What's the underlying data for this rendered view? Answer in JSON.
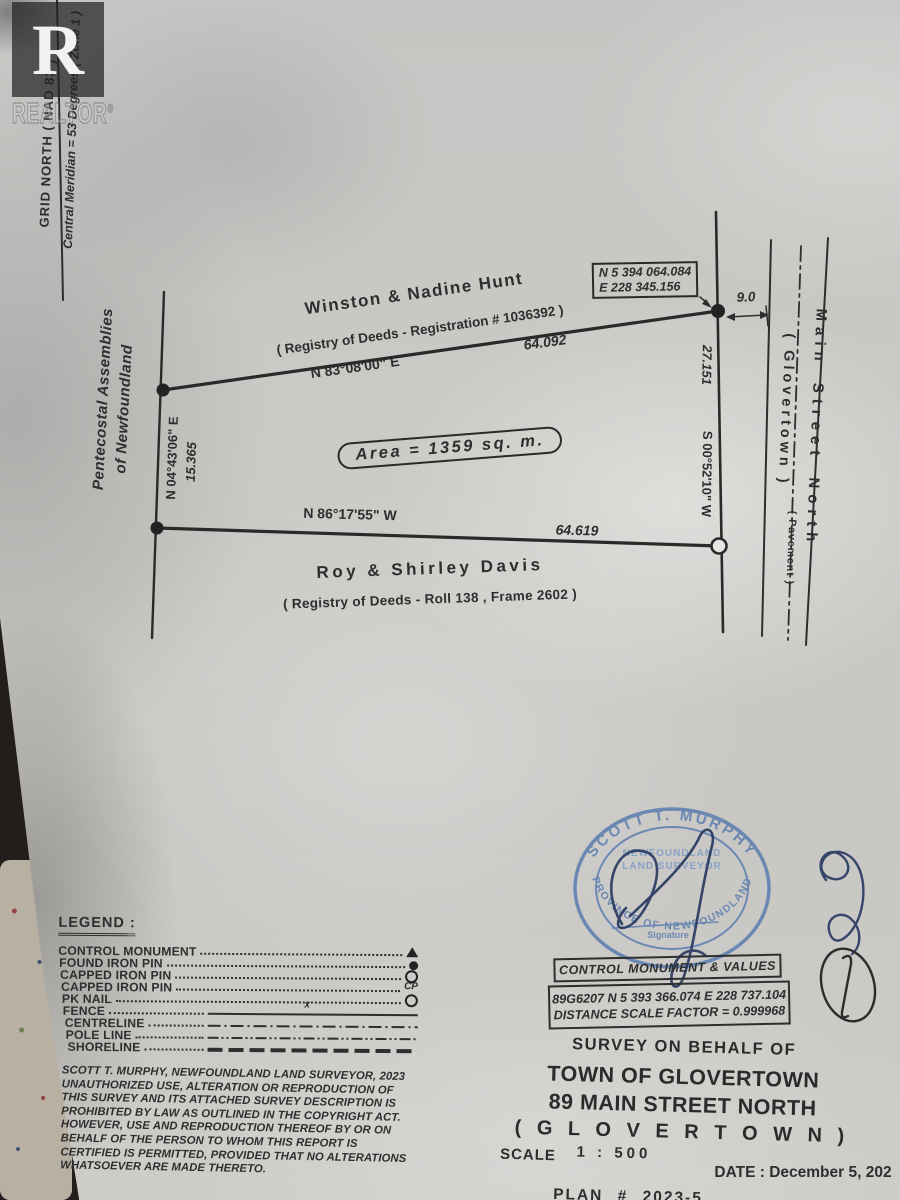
{
  "watermark": {
    "logo_letter": "R",
    "brand": "REALTOR",
    "registered": "®"
  },
  "north": {
    "grid_north": "GRID  NORTH  ( NAD 83 )",
    "central_meridian": "Central Meridian  =  53 Degrees  ( Zone 1 )"
  },
  "parcel": {
    "area_label": "Area  =  1359 sq. m.",
    "north_neighbor": {
      "name": "Winston & Nadine Hunt",
      "registry": "( Registry of Deeds - Registration  #  1036392 )"
    },
    "south_neighbor": {
      "name": "Roy & Shirley Davis",
      "registry": "( Registry of Deeds -  Roll 138 ,  Frame 2602 )"
    },
    "west_neighbor": {
      "line1": "Pentecostal Assemblies",
      "line2": "of Newfoundland"
    },
    "boundaries": {
      "north": {
        "bearing": "N  83°08'00\"  E",
        "distance": "64.092"
      },
      "south": {
        "bearing": "N  86°17'55\"  W",
        "distance": "64.619"
      },
      "west": {
        "bearing": "N 04°43'06\" E",
        "distance": "15.365"
      },
      "east": {
        "bearing": "S 00°52'10\" W",
        "distance": "27.151"
      }
    },
    "corner_coordinates": {
      "northing": "N 5 394 064.084",
      "easting": "E   228 345.156"
    },
    "street_offset": "9.0"
  },
  "street": {
    "name": "Main Street North",
    "paren": "( Glovertown )",
    "surface": "( Pavement )"
  },
  "legend": {
    "title": "LEGEND :",
    "items": [
      {
        "label": "CONTROL MONUMENT",
        "symbol": "control-monument-triangle"
      },
      {
        "label": "FOUND IRON PIN",
        "symbol": "found-iron-pin-filled-circle"
      },
      {
        "label": "CAPPED IRON PIN",
        "symbol": "capped-iron-pin-open-circle"
      },
      {
        "label": "CAPPED IRON PIN",
        "symbol": "capped-iron-pin-cp"
      },
      {
        "label": "PK NAIL",
        "symbol": "pk-nail-circle"
      },
      {
        "label": "FENCE",
        "symbol": "fence-line"
      },
      {
        "label": "CENTRELINE",
        "symbol": "centreline"
      },
      {
        "label": "POLE LINE",
        "symbol": "pole-line"
      },
      {
        "label": "SHORELINE",
        "symbol": "shoreline"
      }
    ],
    "cp_text": "CP",
    "fence_x": "x"
  },
  "copyright": {
    "lines": [
      "SCOTT T. MURPHY, NEWFOUNDLAND LAND SURVEYOR, 2023",
      "UNAUTHORIZED USE, ALTERATION OR REPRODUCTION OF",
      "THIS SURVEY AND ITS ATTACHED SURVEY DESCRIPTION IS",
      "PROHIBITED BY LAW AS OUTLINED IN THE COPYRIGHT ACT.",
      "HOWEVER, USE AND REPRODUCTION THEREOF BY OR ON",
      "BEHALF OF THE PERSON TO WHOM THIS REPORT IS",
      "CERTIFIED IS  PERMITTED, PROVIDED THAT NO ALTERATIONS",
      "WHATSOEVER  ARE MADE THERETO."
    ]
  },
  "stamp": {
    "arc_top": "SCOTT  T.  MURPHY",
    "line1": "NEWFOUNDLAND",
    "line2": "LAND SURVEYOR",
    "signature_caption": "Signature",
    "arc_bottom": "PROVINCE OF NEWFOUNDLAND"
  },
  "control_monument": {
    "title": "CONTROL MONUMENT & VALUES",
    "values": "89G6207   N 5 393 366.074   E 228 737.104",
    "scale_factor": "DISTANCE SCALE FACTOR = 0.999968"
  },
  "title_block": {
    "behalf": "SURVEY ON BEHALF OF",
    "client": "TOWN OF GLOVERTOWN",
    "address": "89 MAIN STREET NORTH",
    "town": "( G L O V E R T O W N )",
    "scale_label": "SCALE",
    "scale_value": "1   :   500",
    "date": "DATE :  December 5, 202",
    "plan": "PLAN    #    2023-5"
  },
  "colors": {
    "ink": "#2e2e2e",
    "stamp_blue": "#5b7db0",
    "signature_ink": "#26375f",
    "paper": "#c9c8c5"
  }
}
